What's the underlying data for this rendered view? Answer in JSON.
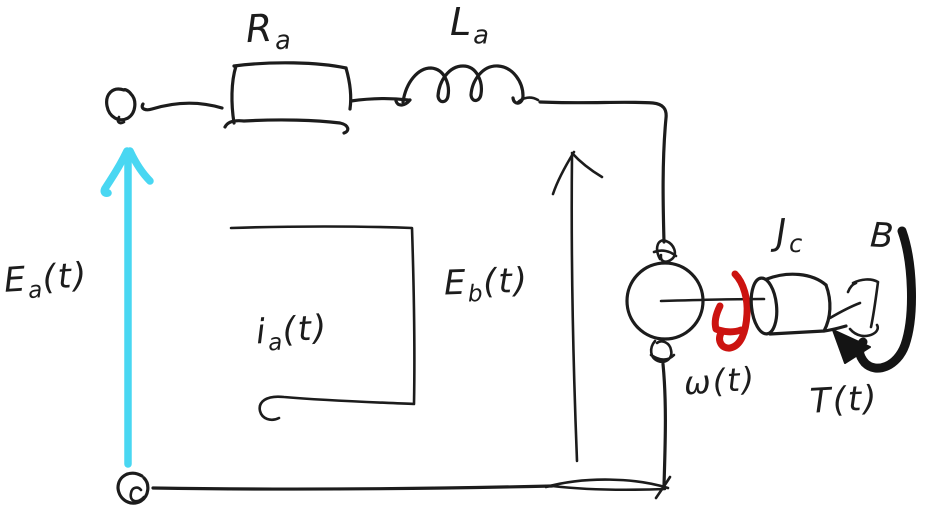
{
  "colors": {
    "ink": "#1c1c1c",
    "ea-arrow": "#49d7f2",
    "omega-arrow": "#cc1310",
    "torque-arrow": "#141414",
    "background": "#ffffff"
  },
  "labels": {
    "resistor": {
      "base": "R",
      "sub": "a",
      "rest": ""
    },
    "inductor": {
      "base": "L",
      "sub": "a",
      "rest": ""
    },
    "input_voltage": {
      "base": "E",
      "sub": "a",
      "rest": "(t)"
    },
    "back_emf": {
      "base": "E",
      "sub": "b",
      "rest": "(t)"
    },
    "armature_current": {
      "base": "i",
      "sub": "a",
      "rest": "(t)"
    },
    "angular_velocity": {
      "base": "ω",
      "sub": "",
      "rest": "(t)"
    },
    "torque": {
      "base": "T",
      "sub": "",
      "rest": "(t)"
    },
    "inertia": {
      "base": "J",
      "sub": "c",
      "rest": ""
    },
    "damping": {
      "base": "B",
      "sub": "",
      "rest": ""
    }
  }
}
